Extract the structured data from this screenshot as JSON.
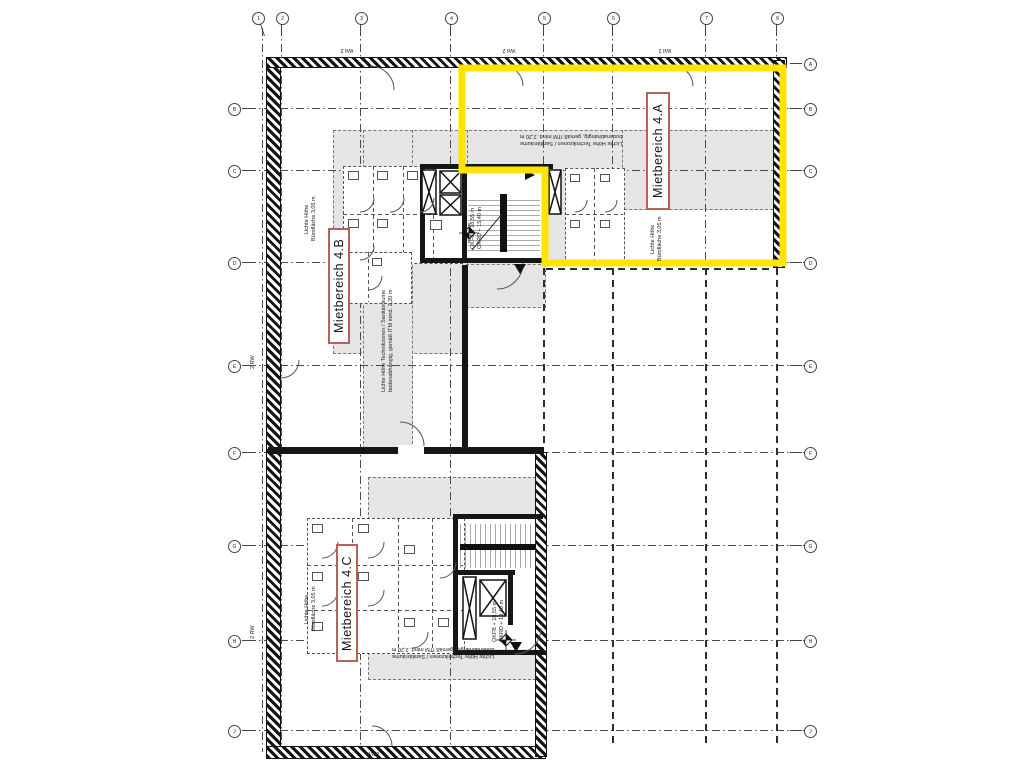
{
  "plan": {
    "areas": {
      "a": "Mietbereich 4.A",
      "b": "Mietbereich 4.B",
      "c": "Mietbereich 4.C"
    },
    "tech_note": {
      "line1": "Lichte Höhe Technikzonen / Sanitärräume",
      "line2": "bodenabhängig, gemäß ITM mind. 2,20 m"
    },
    "office_note": {
      "line1": "Lichte Höhe",
      "line2": "Bürofläche 3,05 m"
    },
    "level_upper": {
      "line1": "OKFB + 18,55 m",
      "line2": "OKRD + 15,40 m"
    },
    "level_lower": {
      "line1": "OKFB + 18,55 m",
      "line2": "OKRD + 18,40 m"
    },
    "wall_tag": "Wd 2",
    "riser_tag": "2 RW"
  },
  "grid": {
    "top": [
      "1",
      "2",
      "3",
      "4",
      "5",
      "6",
      "7",
      "8"
    ],
    "left": [
      "B",
      "C",
      "D",
      "E",
      "F",
      "G",
      "H",
      "J"
    ],
    "right": [
      "A",
      "B",
      "C",
      "D",
      "E",
      "F",
      "G",
      "H",
      "J"
    ]
  },
  "colors": {
    "highlight": "#ffe400",
    "zone_fill": "#e5e5e5",
    "label_border": "#b5625c",
    "wall": "#141414"
  }
}
